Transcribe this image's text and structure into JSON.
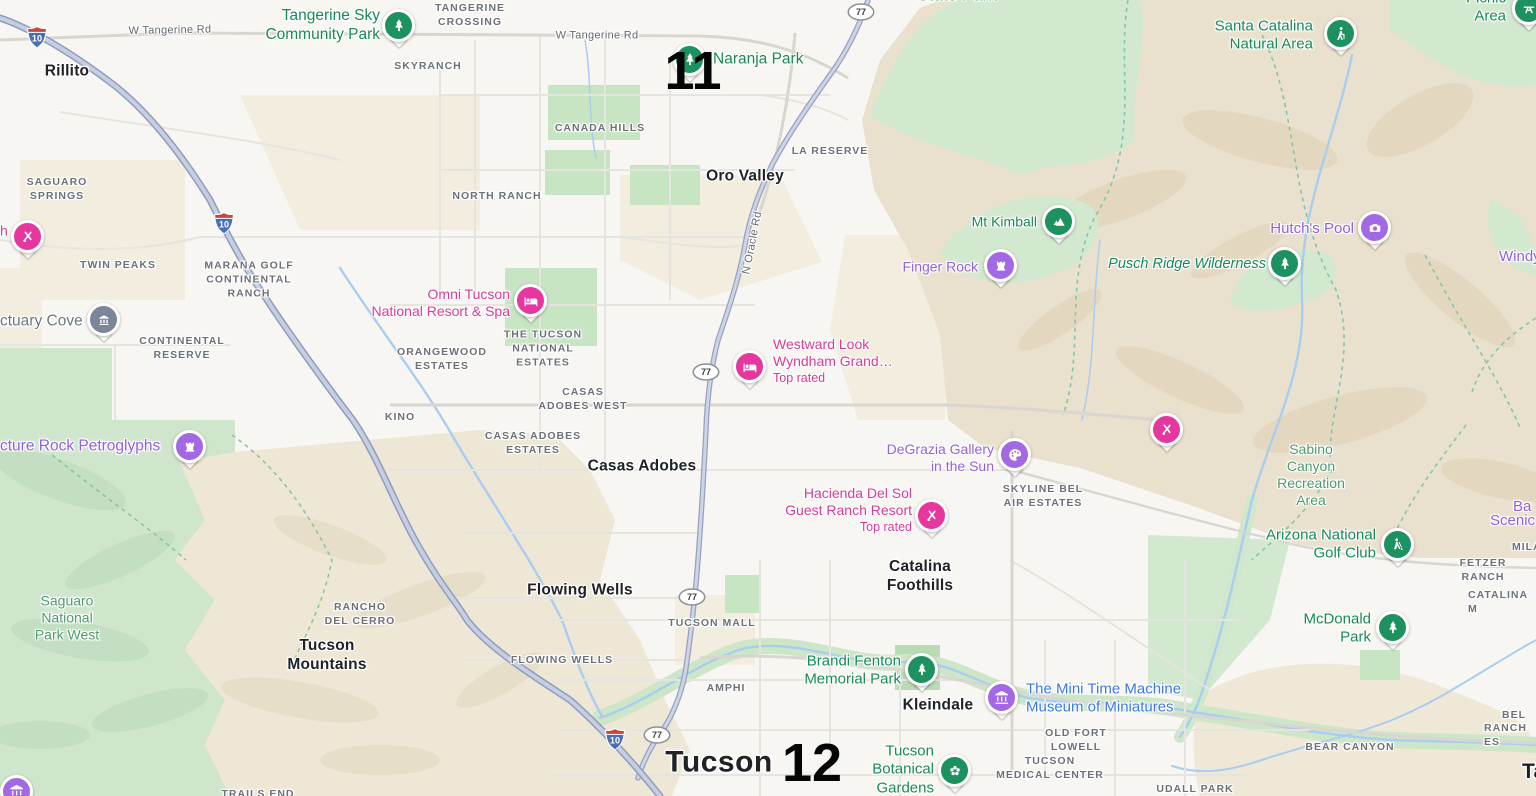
{
  "map": {
    "colors": {
      "green_poi": "#178a55",
      "green_area": "#4f9a6d",
      "purple": "#9460dd",
      "pink": "#d93a96",
      "blue": "#3b78e8",
      "gray_poi": "#70757e",
      "pin_green": "#1d9160",
      "pin_purple": "#a368e3",
      "pin_pink": "#e5379e",
      "pin_gray": "#7c8699"
    },
    "overlay_markers": [
      {
        "label": "11",
        "x": 693,
        "y": 71
      },
      {
        "label": "12",
        "x": 812,
        "y": 763
      }
    ],
    "highway_shields": {
      "interstate": [
        {
          "label": "10",
          "x": 37,
          "y": 37
        },
        {
          "label": "10",
          "x": 224,
          "y": 223
        },
        {
          "label": "10",
          "x": 615,
          "y": 739
        }
      ],
      "state_route": [
        {
          "label": "77",
          "x": 861,
          "y": 12
        },
        {
          "label": "77",
          "x": 706,
          "y": 372
        },
        {
          "label": "77",
          "x": 692,
          "y": 597
        },
        {
          "label": "77",
          "x": 657,
          "y": 735
        }
      ]
    },
    "road_labels": [
      {
        "text": "W Tangerine Rd",
        "x": 170,
        "y": 31,
        "rotate": -1,
        "anchor": "center"
      },
      {
        "text": "W Tangerine Rd",
        "x": 597,
        "y": 36,
        "rotate": 0,
        "anchor": "center"
      },
      {
        "text": "N Oracle Rd",
        "x": 753,
        "y": 243,
        "rotate": -79,
        "anchor": "center"
      }
    ],
    "city_labels": [
      {
        "text": "Rillito",
        "x": 67,
        "y": 72,
        "anchor": "center"
      },
      {
        "text": "Oro Valley",
        "x": 745,
        "y": 177,
        "anchor": "center"
      },
      {
        "text": "Casas Adobes",
        "x": 642,
        "y": 467,
        "anchor": "center"
      },
      {
        "text": "Flowing Wells",
        "x": 580,
        "y": 591,
        "anchor": "center"
      },
      {
        "text": "Tucson\nMountains",
        "x": 327,
        "y": 656,
        "anchor": "center"
      },
      {
        "text": "Catalina\nFoothills",
        "x": 920,
        "y": 577,
        "anchor": "center"
      },
      {
        "text": "Kleindale",
        "x": 938,
        "y": 706,
        "anchor": "center"
      },
      {
        "text": "Tucson",
        "x": 719,
        "y": 763,
        "anchor": "center",
        "variant": "big"
      },
      {
        "text": "Ta",
        "x": 1522,
        "y": 772,
        "anchor": "left",
        "variant": "med"
      }
    ],
    "district_labels": [
      {
        "text": "TANGERINE\nCROSSING",
        "x": 470,
        "y": 15,
        "anchor": "center"
      },
      {
        "text": "SKYRANCH",
        "x": 428,
        "y": 66,
        "anchor": "center"
      },
      {
        "text": "NORTH RANCH",
        "x": 497,
        "y": 196,
        "anchor": "center"
      },
      {
        "text": "CANADA HILLS",
        "x": 600,
        "y": 128,
        "anchor": "center"
      },
      {
        "text": "LA RESERVE",
        "x": 830,
        "y": 151,
        "anchor": "center"
      },
      {
        "text": "SAGUARO\nSPRINGS",
        "x": 57,
        "y": 189,
        "anchor": "center"
      },
      {
        "text": "TWIN PEAKS",
        "x": 118,
        "y": 265,
        "anchor": "center"
      },
      {
        "text": "MARANA GOLF\nCONTINENTAL\nRANCH",
        "x": 249,
        "y": 280,
        "anchor": "center"
      },
      {
        "text": "CONTINENTAL\nRESERVE",
        "x": 182,
        "y": 348,
        "anchor": "center"
      },
      {
        "text": "ORANGEWOOD\nESTATES",
        "x": 442,
        "y": 359,
        "anchor": "center"
      },
      {
        "text": "THE TUCSON\nNATIONAL\nESTATES",
        "x": 543,
        "y": 349,
        "anchor": "center"
      },
      {
        "text": "CASAS\nADOBES WEST",
        "x": 583,
        "y": 399,
        "anchor": "center"
      },
      {
        "text": "KINO",
        "x": 400,
        "y": 417,
        "anchor": "center"
      },
      {
        "text": "CASAS ADOBES\nESTATES",
        "x": 533,
        "y": 443,
        "anchor": "center"
      },
      {
        "text": "SKYLINE BEL\nAIR ESTATES",
        "x": 1043,
        "y": 496,
        "anchor": "center"
      },
      {
        "text": "RANCHO\nDEL CERRO",
        "x": 360,
        "y": 614,
        "anchor": "center"
      },
      {
        "text": "TUCSON MALL",
        "x": 712,
        "y": 623,
        "anchor": "center"
      },
      {
        "text": "FLOWING WELLS",
        "x": 562,
        "y": 660,
        "anchor": "center"
      },
      {
        "text": "AMPHI",
        "x": 726,
        "y": 688,
        "anchor": "center"
      },
      {
        "text": "OLD FORT\nLOWELL",
        "x": 1076,
        "y": 740,
        "anchor": "center"
      },
      {
        "text": "TUCSON\nMEDICAL CENTER",
        "x": 1050,
        "y": 768,
        "anchor": "center"
      },
      {
        "text": "BEAR CANYON",
        "x": 1350,
        "y": 747,
        "anchor": "center"
      },
      {
        "text": "UDALL PARK",
        "x": 1195,
        "y": 789,
        "anchor": "center"
      },
      {
        "text": "TRAILS END",
        "x": 258,
        "y": 794,
        "anchor": "center"
      },
      {
        "text": "FETZER RANCH",
        "x": 1483,
        "y": 570,
        "anchor": "center"
      },
      {
        "text": "MILA",
        "x": 1512,
        "y": 547,
        "anchor": "left"
      },
      {
        "text": "CATALINA M",
        "x": 1468,
        "y": 602,
        "anchor": "left"
      },
      {
        "text": "BEL A",
        "x": 1502,
        "y": 722,
        "anchor": "left"
      },
      {
        "text": "RANCH ES",
        "x": 1484,
        "y": 735,
        "anchor": "left"
      }
    ],
    "poi_labels": [
      {
        "text": "Tangerine Sky\nCommunity Park",
        "color": "green_poi",
        "anchor": "right",
        "x": 380,
        "y": 26,
        "size": 15.5
      },
      {
        "text": "Naranja Park",
        "color": "green_poi",
        "anchor": "left",
        "x": 713,
        "y": 60,
        "size": 15.5
      },
      {
        "text": "State Park",
        "color": "green_area",
        "anchor": "center",
        "x": 957,
        "y": -4,
        "size": 17
      },
      {
        "text": "Picnic Area",
        "color": "green_poi",
        "anchor": "right",
        "x": 1506,
        "y": 8,
        "size": 15
      },
      {
        "text": "Santa Catalina\nNatural Area",
        "color": "green_poi",
        "anchor": "right",
        "x": 1313,
        "y": 36,
        "size": 15
      },
      {
        "text": "Mt Kimball",
        "color": "green_poi",
        "anchor": "right",
        "x": 1037,
        "y": 222
      },
      {
        "text": "Hutch's Pool",
        "color": "purple",
        "anchor": "right",
        "x": 1354,
        "y": 229,
        "size": 15
      },
      {
        "text": "Finger Rock",
        "color": "purple",
        "anchor": "right",
        "x": 978,
        "y": 267
      },
      {
        "text": "Pusch Ridge Wilderness",
        "color": "green_poi",
        "anchor": "right",
        "x": 1266,
        "y": 265,
        "italic": true,
        "size": 14.5
      },
      {
        "text": "Windy",
        "color": "purple",
        "anchor": "left",
        "x": 1499,
        "y": 257,
        "size": 15
      },
      {
        "text": "Omni Tucson\nNational Resort & Spa",
        "color": "pink",
        "anchor": "right",
        "x": 510,
        "y": 303
      },
      {
        "text": "Westward Look\nWyndham Grand…",
        "color": "pink",
        "anchor": "left",
        "x": 773,
        "y": 361,
        "sub": "Top rated"
      },
      {
        "text": "DeGrazia Gallery\nin the Sun",
        "color": "purple",
        "anchor": "right",
        "x": 994,
        "y": 458
      },
      {
        "text": "Hacienda Del Sol\nGuest Ranch Resort",
        "color": "pink",
        "anchor": "right",
        "x": 912,
        "y": 510,
        "sub": "Top rated"
      },
      {
        "text": "Sabino\nCanyon\nRecreation\nArea",
        "color": "green_area",
        "anchor": "center",
        "x": 1311,
        "y": 475
      },
      {
        "text": "Ba",
        "color": "purple",
        "anchor": "left",
        "x": 1513,
        "y": 507,
        "size": 15
      },
      {
        "text": "Scenic",
        "color": "purple",
        "anchor": "left",
        "x": 1490,
        "y": 521,
        "size": 15
      },
      {
        "text": "Arizona National\nGolf Club",
        "color": "green_poi",
        "anchor": "right",
        "x": 1376,
        "y": 545,
        "size": 15
      },
      {
        "text": "Saguaro\nNational\nPark West",
        "color": "green_area",
        "anchor": "center",
        "x": 67,
        "y": 618
      },
      {
        "text": "McDonald\nPark",
        "color": "green_poi",
        "anchor": "right",
        "x": 1371,
        "y": 629,
        "size": 15
      },
      {
        "text": "Brandi Fenton\nMemorial Park",
        "color": "green_poi",
        "anchor": "right",
        "x": 901,
        "y": 671,
        "size": 15
      },
      {
        "text": "The Mini Time Machine\nMuseum of Miniatures",
        "color": "blue",
        "anchor": "left",
        "x": 1026,
        "y": 699,
        "size": 15
      },
      {
        "text": "Tucson\nBotanical\nGardens",
        "color": "green_poi",
        "anchor": "right",
        "x": 934,
        "y": 770,
        "size": 15
      },
      {
        "text": "ctuary Cove",
        "color": "gray_poi",
        "anchor": "left",
        "x": 0,
        "y": 322,
        "size": 15.5
      },
      {
        "text": "h",
        "color": "pink",
        "anchor": "left",
        "x": 0,
        "y": 231
      },
      {
        "text": "cture Rock Petroglyphs",
        "color": "purple",
        "anchor": "left",
        "x": 0,
        "y": 447,
        "size": 15.5
      }
    ],
    "pins": [
      {
        "icon": "tree",
        "color": "green",
        "x": 399,
        "y": 26,
        "name": "tangerine-sky-park-pin"
      },
      {
        "icon": "tree",
        "color": "green",
        "x": 690,
        "y": 60,
        "name": "naranja-park-pin"
      },
      {
        "icon": "hiker",
        "color": "green",
        "x": 1341,
        "y": 34,
        "name": "santa-catalina-pin"
      },
      {
        "icon": "picnic",
        "color": "green",
        "x": 1529,
        "y": 9,
        "name": "picnic-area-pin"
      },
      {
        "icon": "mountain",
        "color": "green",
        "x": 1059,
        "y": 222,
        "name": "mt-kimball-pin"
      },
      {
        "icon": "camera",
        "color": "purple",
        "x": 1375,
        "y": 228,
        "name": "hutchs-pool-pin"
      },
      {
        "icon": "rook",
        "color": "purple",
        "x": 1001,
        "y": 266,
        "name": "finger-rock-pin"
      },
      {
        "icon": "tree",
        "color": "green",
        "x": 1285,
        "y": 264,
        "name": "pusch-ridge-pin"
      },
      {
        "icon": "golfcross",
        "color": "pink",
        "x": 28,
        "y": 237,
        "name": "resort-pin-west"
      },
      {
        "icon": "monument",
        "color": "gray",
        "x": 104,
        "y": 320,
        "name": "sanctuary-cove-pin"
      },
      {
        "icon": "hotel",
        "color": "pink",
        "x": 531,
        "y": 301,
        "name": "omni-tucson-pin"
      },
      {
        "icon": "hotel",
        "color": "pink",
        "x": 750,
        "y": 367,
        "name": "westward-look-pin"
      },
      {
        "icon": "rook",
        "color": "purple",
        "x": 190,
        "y": 447,
        "name": "picture-rock-petroglyphs-pin"
      },
      {
        "icon": "golfcross",
        "color": "pink",
        "x": 1167,
        "y": 430,
        "name": "resort-pin-foothills"
      },
      {
        "icon": "palette",
        "color": "purple",
        "x": 1015,
        "y": 455,
        "name": "degrazia-gallery-pin"
      },
      {
        "icon": "golfcross",
        "color": "pink",
        "x": 932,
        "y": 516,
        "name": "hacienda-del-sol-pin"
      },
      {
        "icon": "golfer",
        "color": "green",
        "x": 1398,
        "y": 545,
        "name": "arizona-national-golf-pin"
      },
      {
        "icon": "tree",
        "color": "green",
        "x": 1393,
        "y": 628,
        "name": "mcdonald-park-pin"
      },
      {
        "icon": "tree",
        "color": "green",
        "x": 922,
        "y": 670,
        "name": "brandi-fenton-pin"
      },
      {
        "icon": "museum",
        "color": "purple",
        "x": 1002,
        "y": 698,
        "name": "mini-time-machine-pin"
      },
      {
        "icon": "flower",
        "color": "green",
        "x": 955,
        "y": 771,
        "name": "tucson-botanical-pin"
      },
      {
        "icon": "museum",
        "color": "purple",
        "x": 17,
        "y": 792,
        "name": "corner-museum-pin"
      }
    ]
  }
}
